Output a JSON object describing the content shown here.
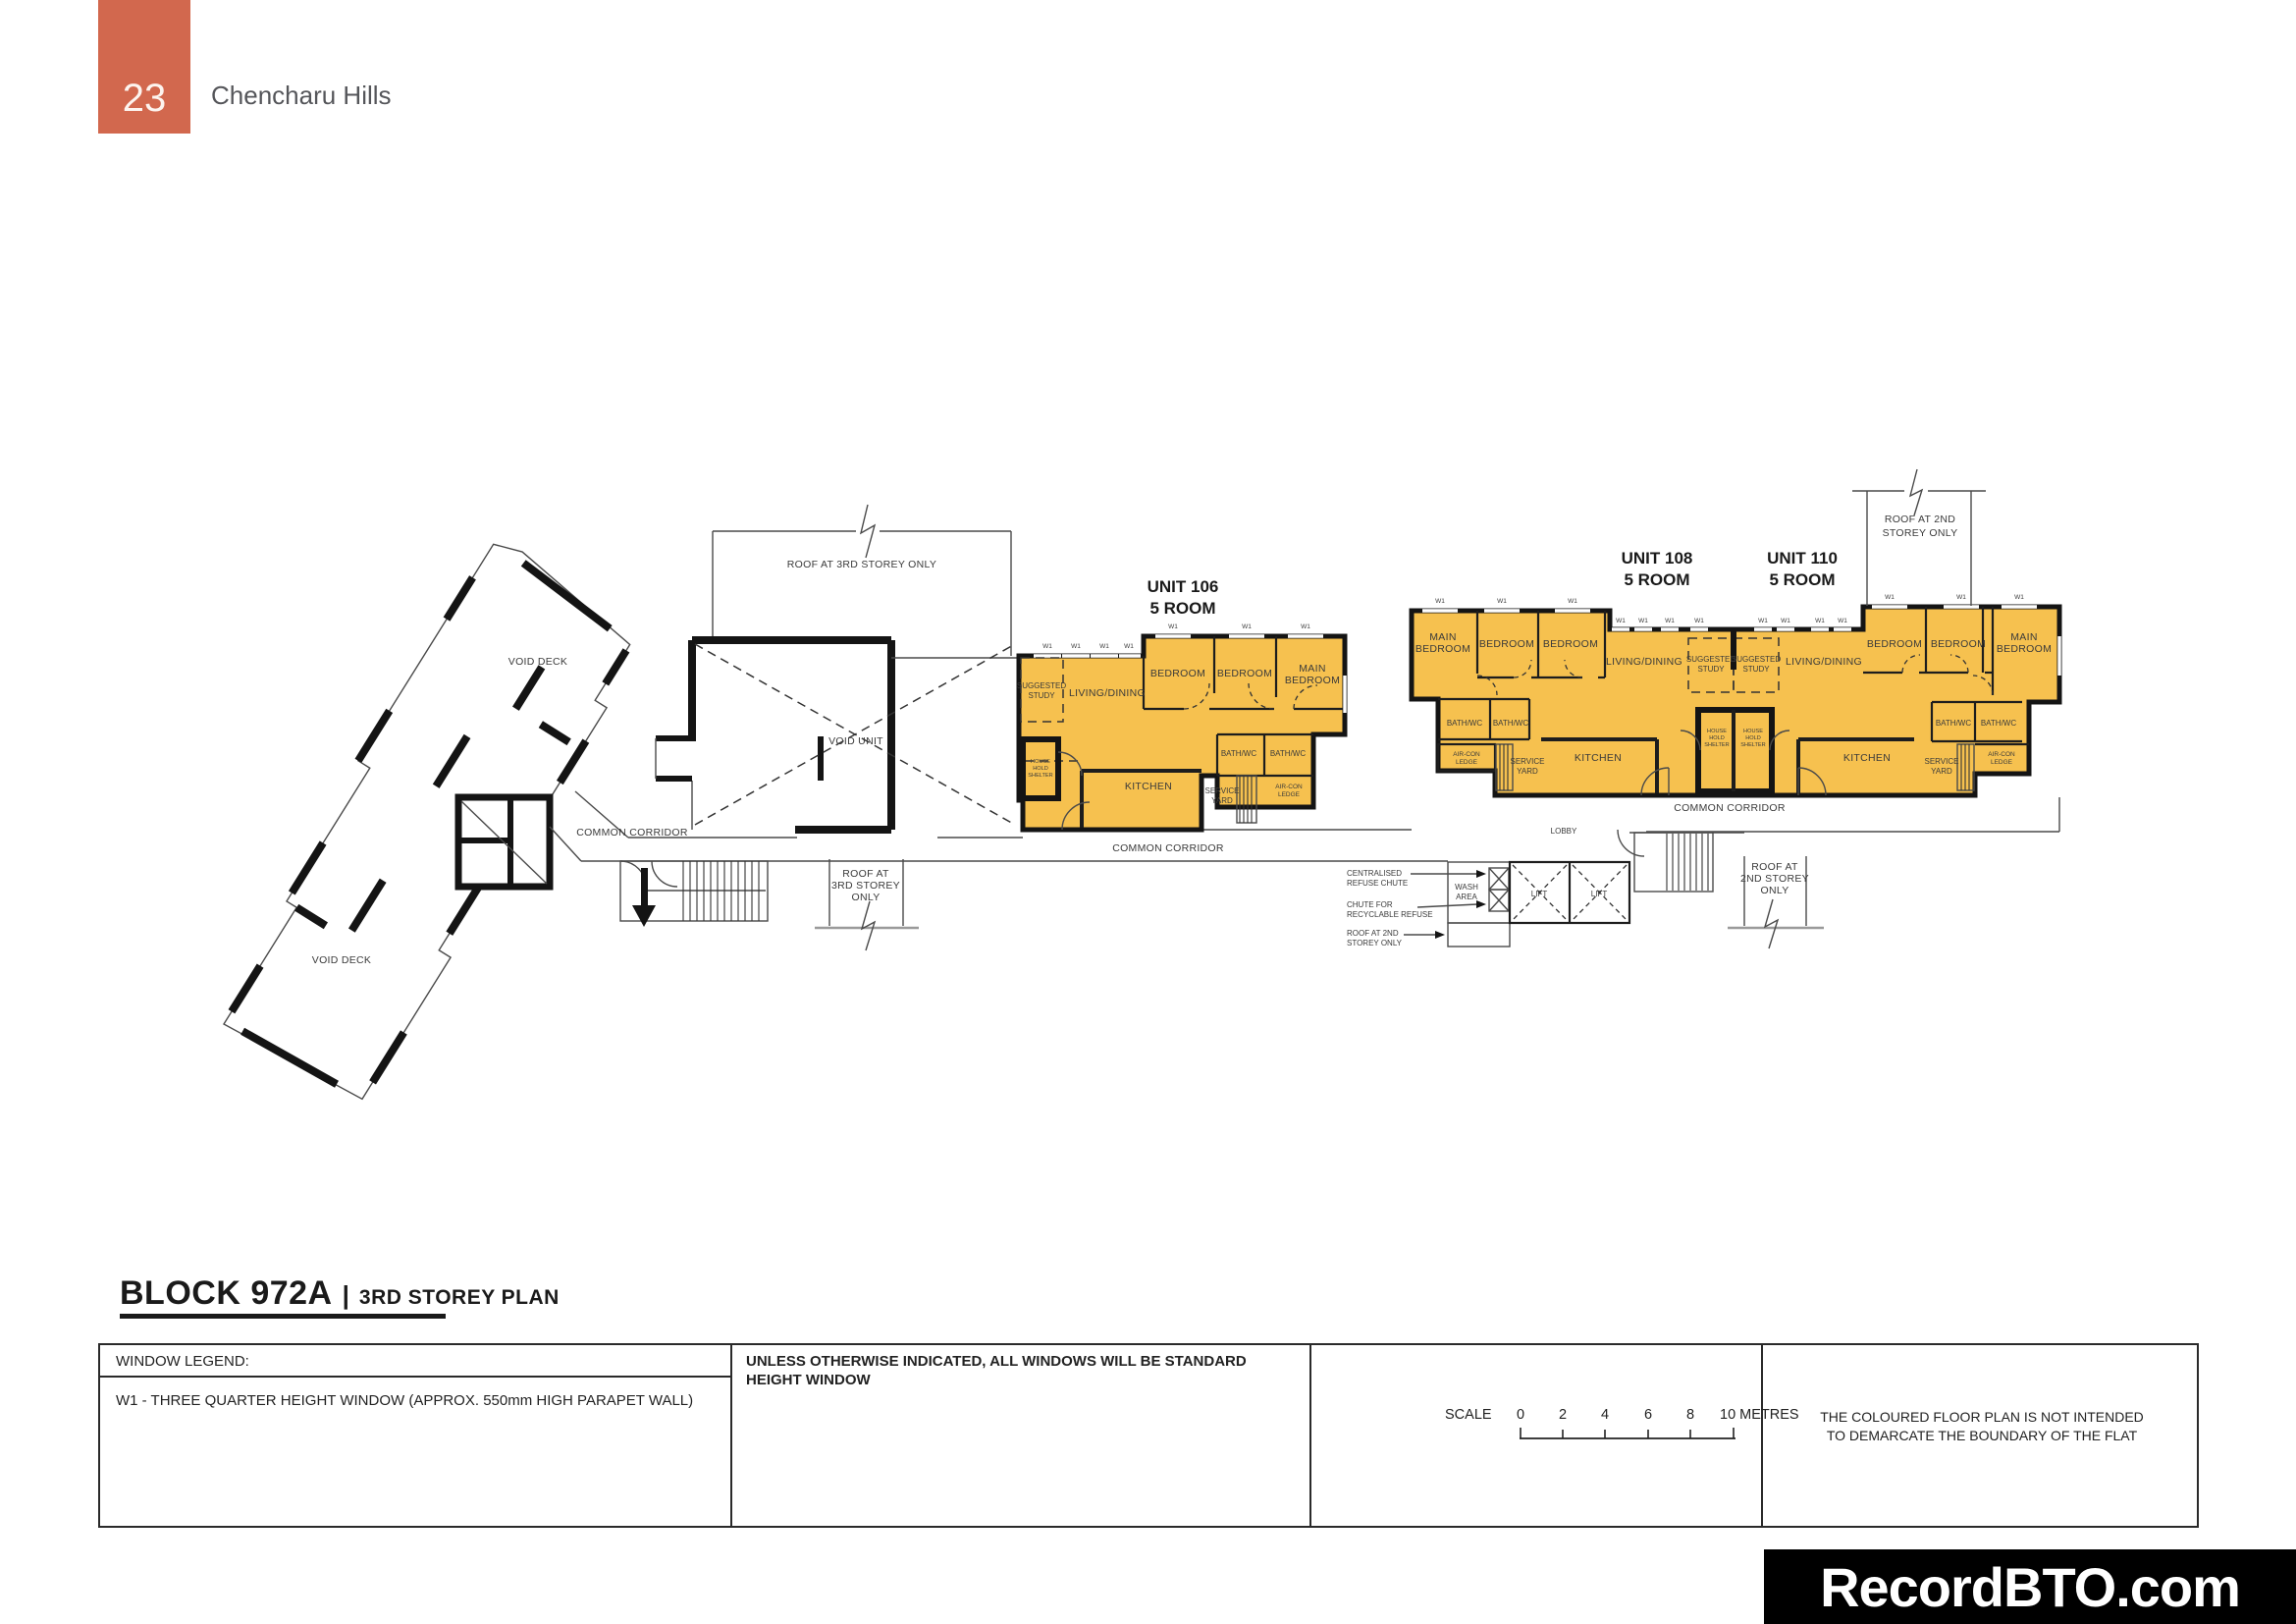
{
  "header": {
    "page_number": "23",
    "project_name": "Chencharu Hills"
  },
  "title": {
    "block": "BLOCK 972A",
    "separator": "|",
    "plan": "3RD STOREY PLAN"
  },
  "units": {
    "u106": {
      "name": "UNIT 106",
      "type": "5 ROOM"
    },
    "u108": {
      "name": "UNIT 108",
      "type": "5 ROOM"
    },
    "u110": {
      "name": "UNIT 110",
      "type": "5 ROOM"
    }
  },
  "rooms": {
    "living": "LIVING/DINING",
    "bedroom": "BEDROOM",
    "main": "MAIN",
    "bath": "BATH/WC",
    "kitchen": "KITCHEN",
    "service_l1": "SERVICE",
    "service_l2": "YARD",
    "study_l1": "SUGGESTED",
    "study_l2": "STUDY",
    "aircon_l1": "AIR-CON",
    "aircon_l2": "LEDGE",
    "hhs_l1": "HOUSE",
    "hhs_l2": "HOLD",
    "hhs_l3": "SHELTER",
    "w1": "W1"
  },
  "annotations": {
    "void_deck": "VOID DECK",
    "void_unit": "VOID UNIT",
    "common_corridor": "COMMON CORRIDOR",
    "lobby": "LOBBY",
    "lift": "LIFT",
    "wash_l1": "WASH",
    "wash_l2": "AREA",
    "roof3_full": "ROOF AT 3RD STOREY ONLY",
    "roof_at": "ROOF AT",
    "storey3": "3RD STOREY",
    "storey2": "2ND STOREY",
    "only": "ONLY",
    "roof2_l1": "ROOF AT 2ND",
    "roof2_l2": "STOREY ONLY",
    "chute1_l1": "CENTRALISED",
    "chute1_l2": "REFUSE CHUTE",
    "chute2_l1": "CHUTE FOR",
    "chute2_l2": "RECYCLABLE REFUSE"
  },
  "legend": {
    "window_legend_title": "WINDOW LEGEND:",
    "w1_description": "W1 - THREE QUARTER HEIGHT WINDOW (APPROX. 550mm HIGH PARAPET WALL)",
    "note_l1": "UNLESS OTHERWISE INDICATED, ALL WINDOWS WILL BE STANDARD",
    "note_l2": "HEIGHT WINDOW",
    "disclaimer_l1": "THE COLOURED FLOOR PLAN IS NOT INTENDED",
    "disclaimer_l2": "TO DEMARCATE THE BOUNDARY OF THE FLAT"
  },
  "scale": {
    "label": "SCALE",
    "ticks": [
      "0",
      "2",
      "4",
      "6",
      "8"
    ],
    "end_label": "10 METRES"
  },
  "watermark": "RecordBTO.com",
  "colors": {
    "accent": "#D2684E",
    "unit_fill": "#F6C14F",
    "wall": "#141414"
  }
}
